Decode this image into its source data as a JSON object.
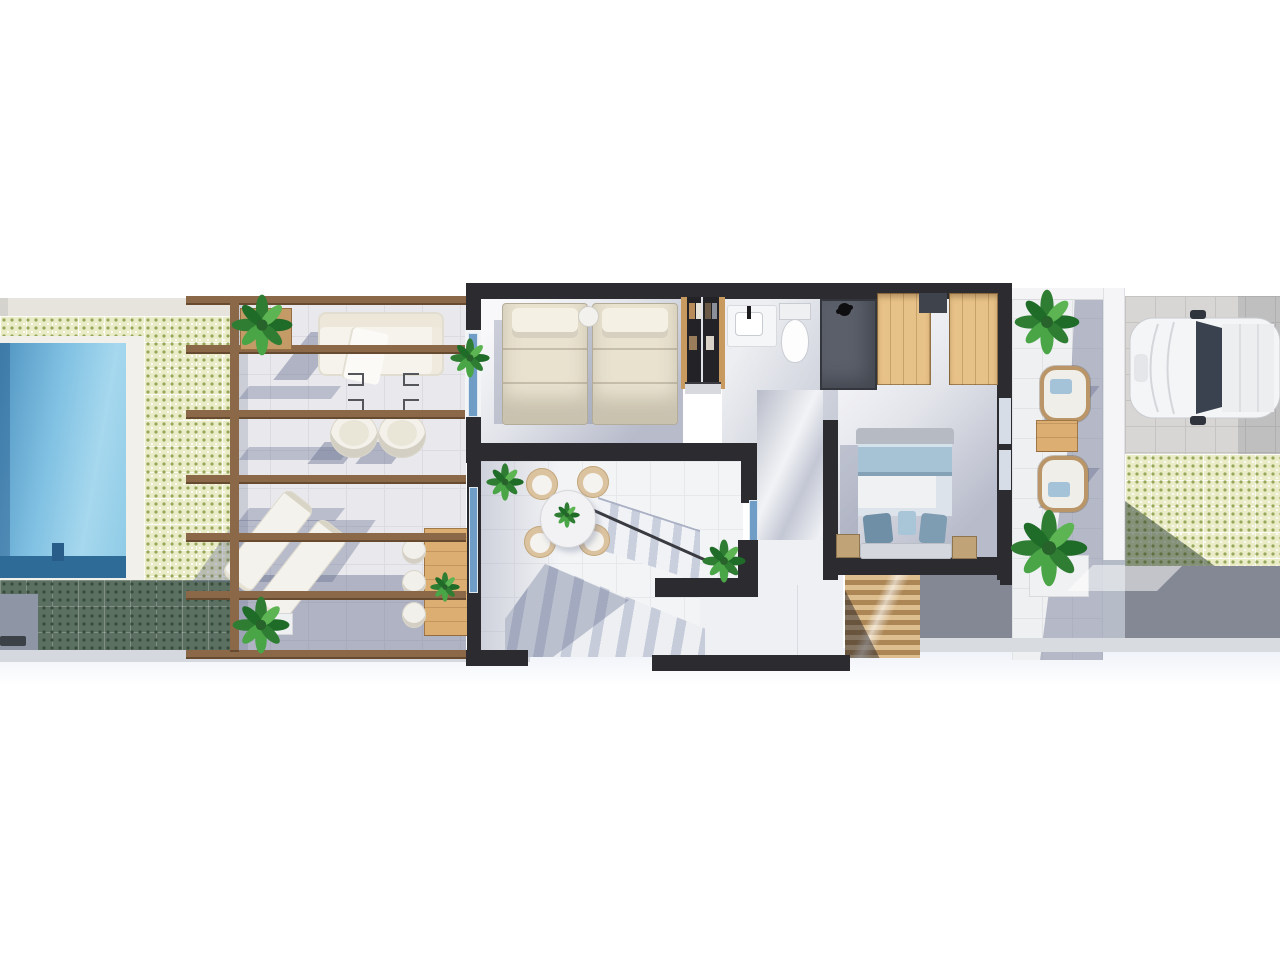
{
  "scene": {
    "type": "floor-plan-3d-render-top-view",
    "background": "#ffffff",
    "note_text_visible": ""
  },
  "colors": {
    "wall": "#2b2b30",
    "terrace-tile": "#e9e9ed",
    "tile-line": "#dbdbe1",
    "green-base": "#e9ecc6",
    "green-dot": "#99a75c",
    "green-shadow-base": "#5c7061",
    "green-shadow-dot": "#374c3e",
    "pool-light": "#a8d8ee",
    "pool-mid": "#5a9fcb",
    "pool-dark": "#2e6b97",
    "wood": "#8a6848",
    "wood-furn": "#dcae72",
    "wardrobe": "#e7c288",
    "slat-light": "#ddbe8e",
    "slat-dark": "#ac8655",
    "floor-dark": "#b7bbca",
    "cream": "#e9e2cf",
    "bed-blue": "#a6c3d6",
    "pillow-blue": "#7e9cb2",
    "glass": "#6f9dc6",
    "pav": "#d7d6d4",
    "pav-line": "#c5c4c1",
    "pav-shadow": "#848894",
    "curb": "#d5d9df",
    "car-body": "#f4f5f7",
    "car-glass": "#3a4250",
    "plant-dark": "#1f6b28",
    "plant-mid": "#2e7d32",
    "plant-light": "#5cb552"
  },
  "areas": [
    {
      "id": "pool",
      "label": "swimming-pool"
    },
    {
      "id": "garden-tiles",
      "label": "patterned-tile-garden"
    },
    {
      "id": "pergola-terrace",
      "label": "pergola-terrace"
    },
    {
      "id": "twin-bedroom",
      "label": "twin-bedroom"
    },
    {
      "id": "closet",
      "label": "built-in-closet"
    },
    {
      "id": "bathroom",
      "label": "bathroom"
    },
    {
      "id": "dining-room",
      "label": "dining-room"
    },
    {
      "id": "staircase",
      "label": "staircase"
    },
    {
      "id": "hallway",
      "label": "hallway"
    },
    {
      "id": "master-bedroom",
      "label": "master-bedroom"
    },
    {
      "id": "side-patio",
      "label": "side-patio"
    },
    {
      "id": "driveway",
      "label": "driveway-parking"
    }
  ],
  "furniture": [
    "outdoor-sofa",
    "outdoor-armchairs",
    "sun-loungers",
    "outdoor-dining-table",
    "single-beds",
    "nightstand",
    "round-dining-table",
    "dining-chairs",
    "double-bed",
    "foot-bench",
    "wardrobes",
    "sink",
    "toilet",
    "shower",
    "louvre-slat-stairs",
    "patio-lounge-chairs",
    "patio-side-table",
    "parked-car",
    "potted-plants",
    "pergola-beams"
  ]
}
